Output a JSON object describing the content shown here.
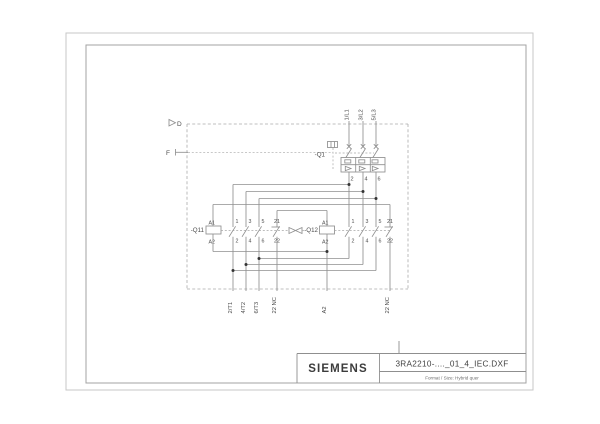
{
  "sheet": {
    "brand": "SIEMENS",
    "drawing_name": "3RA2210-...._01_4_IEC.DXF",
    "format_note": "Format / Size: Hybrid quer"
  },
  "diagram": {
    "zone_top": "D",
    "zone_side": "F",
    "supply_terminals": [
      "1/L1",
      "3/L2",
      "5/L3"
    ],
    "breaker": {
      "label": "-Q1",
      "out_terminals": [
        "2",
        "4",
        "6"
      ]
    },
    "contactor_left": {
      "label": "-Q11",
      "coil_top": "A1",
      "coil_bottom": "A2",
      "contacts_top": [
        "1",
        "3",
        "5",
        "21"
      ],
      "contacts_bottom": [
        "2",
        "4",
        "6",
        "22"
      ]
    },
    "contactor_right": {
      "label": "-Q12",
      "coil_top": "A1",
      "coil_bottom": "A2",
      "contacts_top": [
        "1",
        "3",
        "5",
        "21"
      ],
      "contacts_bottom": [
        "2",
        "4",
        "6",
        "22"
      ]
    },
    "bottom_terminals": [
      "2/T1",
      "4/T2",
      "6/T3",
      "22 NC",
      "A2",
      "22 NC"
    ]
  }
}
